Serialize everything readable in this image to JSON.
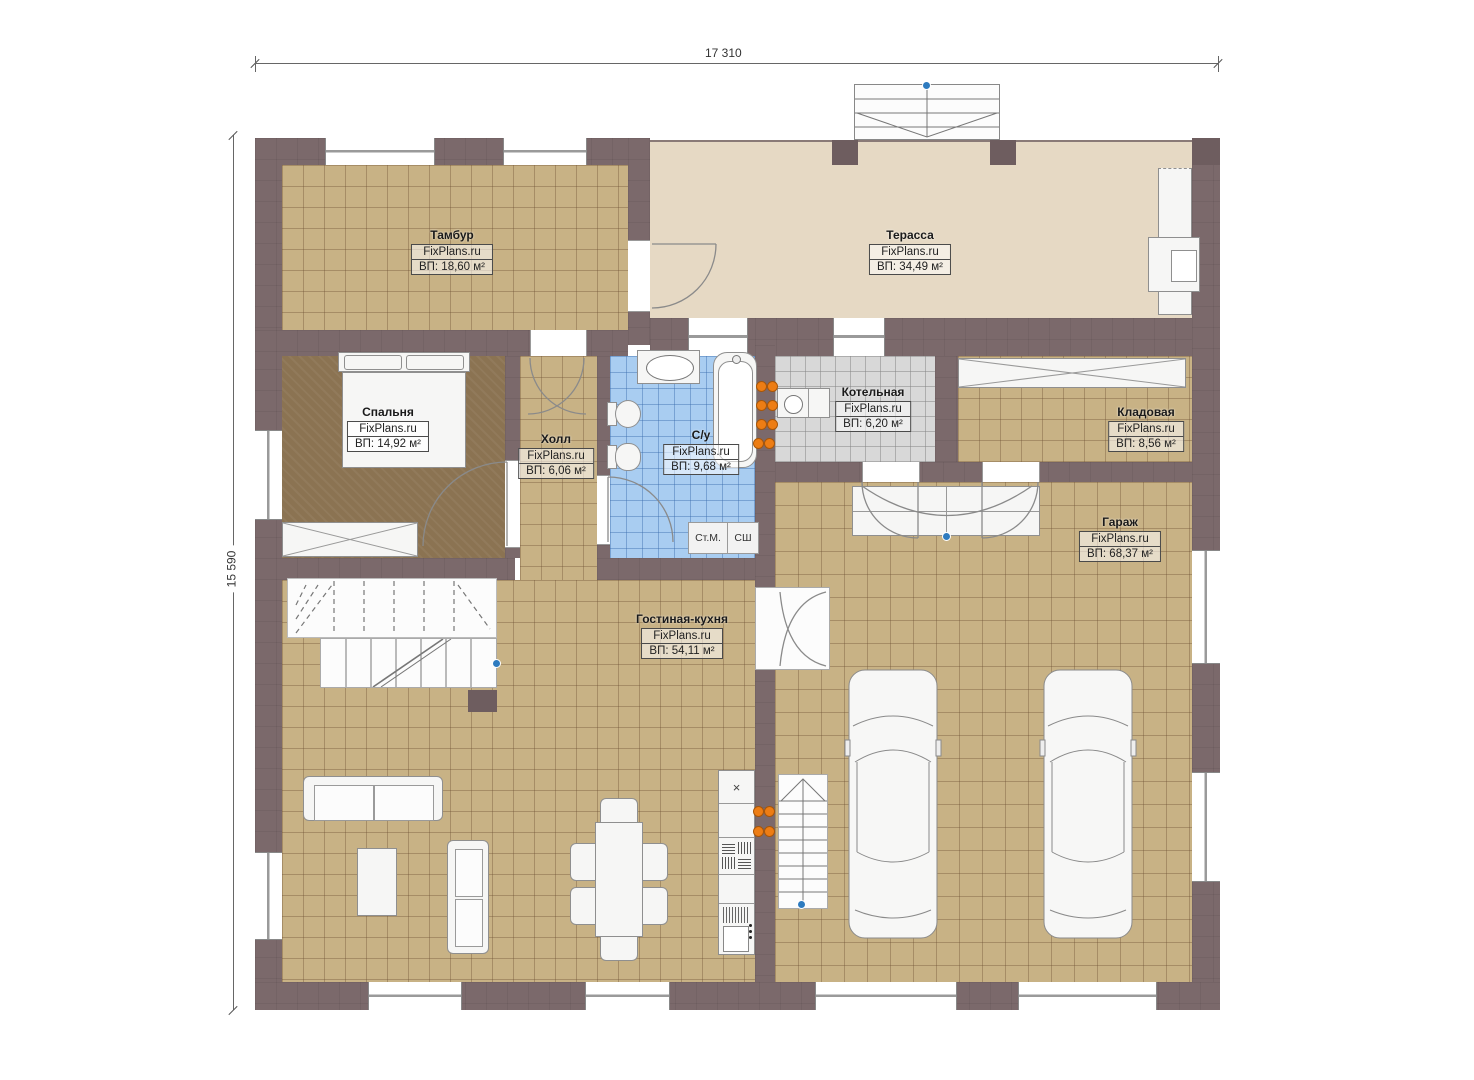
{
  "page": {
    "type": "floor-plan",
    "source": "FixPlans.ru"
  },
  "dimensions": {
    "width": "17 310",
    "height": "15 590"
  },
  "rooms": [
    {
      "name": "Тамбур",
      "brand": "FixPlans.ru",
      "area": "ВП: 18,60 м²"
    },
    {
      "name": "Терасса",
      "brand": "FixPlans.ru",
      "area": "ВП: 34,49 м²"
    },
    {
      "name": "Спальня",
      "brand": "FixPlans.ru",
      "area": "ВП: 14,92 м²"
    },
    {
      "name": "Холл",
      "brand": "FixPlans.ru",
      "area": "ВП: 6,06 м²"
    },
    {
      "name": "С/у",
      "brand": "FixPlans.ru",
      "area": "ВП: 9,68 м²"
    },
    {
      "name": "Котельная",
      "brand": "FixPlans.ru",
      "area": "ВП: 6,20 м²"
    },
    {
      "name": "Кладовая",
      "brand": "FixPlans.ru",
      "area": "ВП: 8,56 м²"
    },
    {
      "name": "Гараж",
      "brand": "FixPlans.ru",
      "area": "ВП: 68,37 м²"
    },
    {
      "name": "Гостиная-кухня",
      "brand": "FixPlans.ru",
      "area": "ВП: 54,11 м²"
    }
  ],
  "appliances": {
    "washing_machine": "Ст.М.",
    "dryer": "СШ"
  },
  "kitchen": {
    "sink_mark": "×"
  },
  "colors": {
    "wall": "#7b696b",
    "floor_tile": "#c8b285",
    "bedroom_floor": "#8b7352",
    "bathroom_tile": "#a9cdf1",
    "boiler_tile": "#d8d8d8",
    "terrace_floor": "#e6d9c4",
    "radiator_orange": "#ed7d14",
    "marker_blue": "#2e7bbf"
  }
}
